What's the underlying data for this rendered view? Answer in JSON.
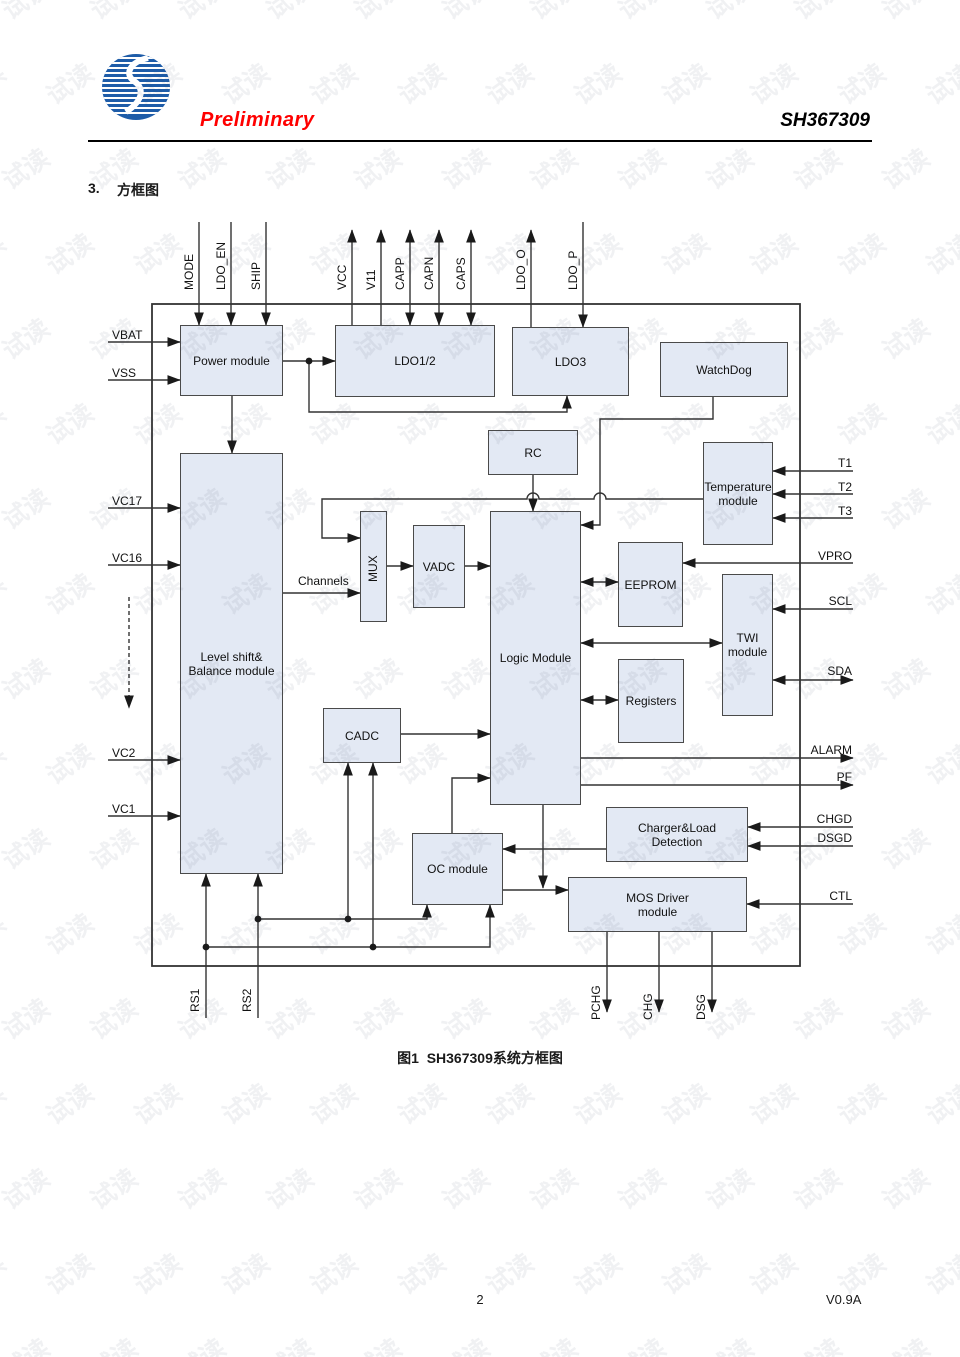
{
  "header": {
    "logo": "sino-wealth-logo",
    "preliminary": "Preliminary",
    "part_number": "SH367309"
  },
  "section": {
    "number": "3.",
    "title": "方框图"
  },
  "figure_caption": "图1  SH367309系统方框图",
  "footer": {
    "page_number": "2",
    "version": "V0.9A"
  },
  "watermark": {
    "text": "试读"
  },
  "colors": {
    "logo_blue": "#1e5ca8",
    "preliminary_red": "#ff0000",
    "block_fill": "#e3e9f4",
    "block_border": "#4a4a4a",
    "line": "#333333",
    "watermark_gray": "#ebebeb"
  },
  "diagram": {
    "blocks": {
      "power": "Power module",
      "ldo12": "LDO1/2",
      "ldo3": "LDO3",
      "watchdog": "WatchDog",
      "rc": "RC",
      "temperature": "Temperature module",
      "levelshift": "Level shift& Balance module",
      "mux": "MUX",
      "vadc": "VADC",
      "logic": "Logic Module",
      "eeprom": "EEPROM",
      "twi": "TWI module",
      "registers": "Registers",
      "cadc": "CADC",
      "oc": "OC module",
      "charger": "Charger&Load Detection",
      "mosdriver": "MOS Driver module"
    },
    "labels": {
      "channels": "Channels"
    },
    "signals": {
      "mode": "MODE",
      "ldo_en": "LDO_EN",
      "ship": "SHIP",
      "vcc": "VCC",
      "v11": "V11",
      "capp": "CAPP",
      "capn": "CAPN",
      "caps": "CAPS",
      "ldo_o": "LDO_O",
      "ldo_p": "LDO_P",
      "vbat": "VBAT",
      "vss": "VSS",
      "vc17": "VC17",
      "vc16": "VC16",
      "vc2": "VC2",
      "vc1": "VC1",
      "t1": "T1",
      "t2": "T2",
      "t3": "T3",
      "vpro": "VPRO",
      "scl": "SCL",
      "sda": "SDA",
      "alarm": "ALARM",
      "pf": "PF",
      "chgd": "CHGD",
      "dsgd": "DSGD",
      "ctl": "CTL",
      "rs1": "RS1",
      "rs2": "RS2",
      "pchg": "PCHG",
      "chg": "CHG",
      "dsg": "DSG"
    }
  }
}
